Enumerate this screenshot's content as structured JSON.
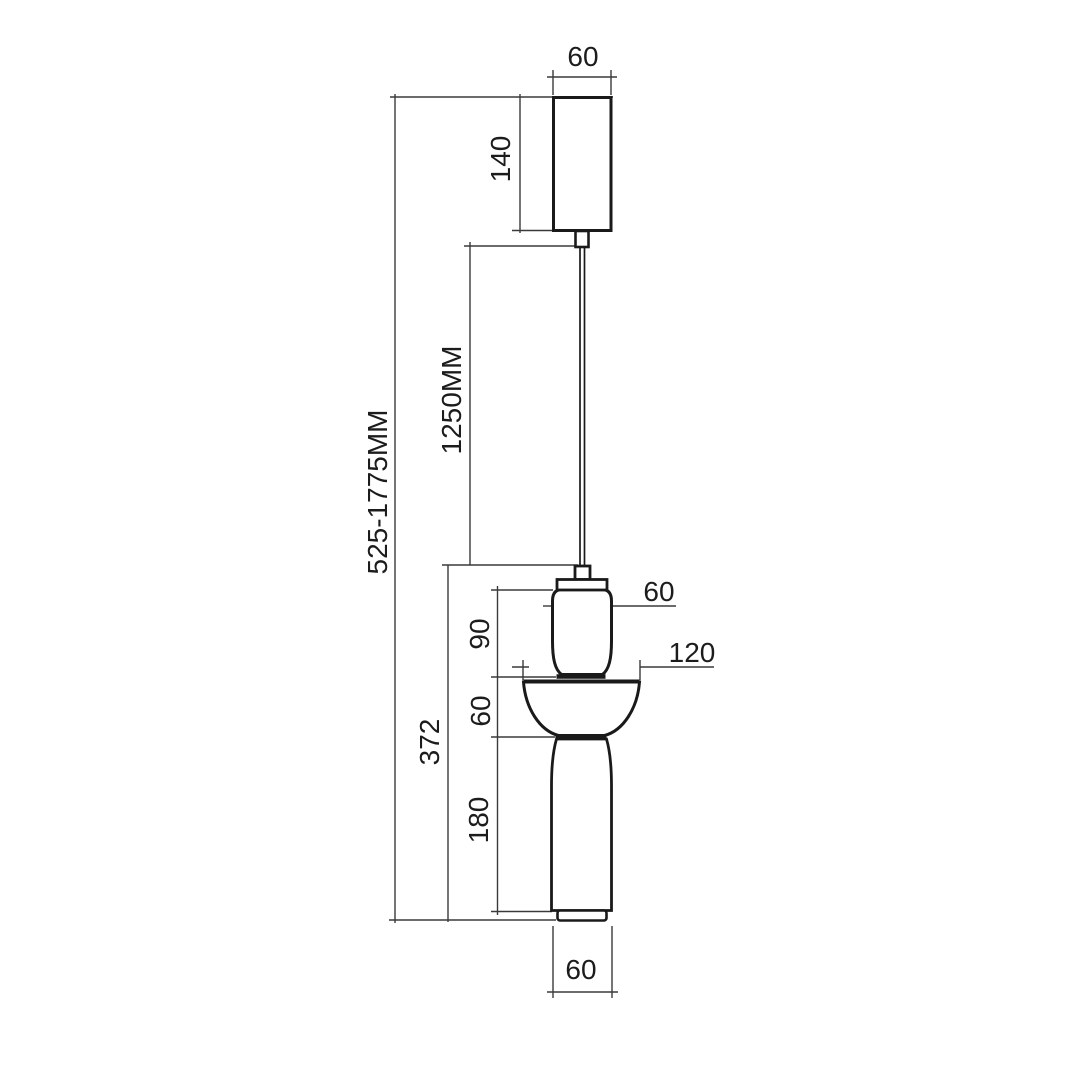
{
  "drawing": {
    "subject": "pendant-lamp-dimension-drawing",
    "colors": {
      "background": "#ffffff",
      "dimension_line": "#3a3a3a",
      "shape_outline": "#1a1a1a"
    },
    "dimensions": {
      "canopy_width": "60",
      "canopy_height": "140",
      "cable_length": "1250MM",
      "overall_height_range": "525-1775MM",
      "fixture_height": "372",
      "head_height": "90",
      "shade_height": "60",
      "body_height": "180",
      "head_diameter": "60",
      "shade_diameter": "120",
      "bottom_diameter": "60"
    }
  }
}
